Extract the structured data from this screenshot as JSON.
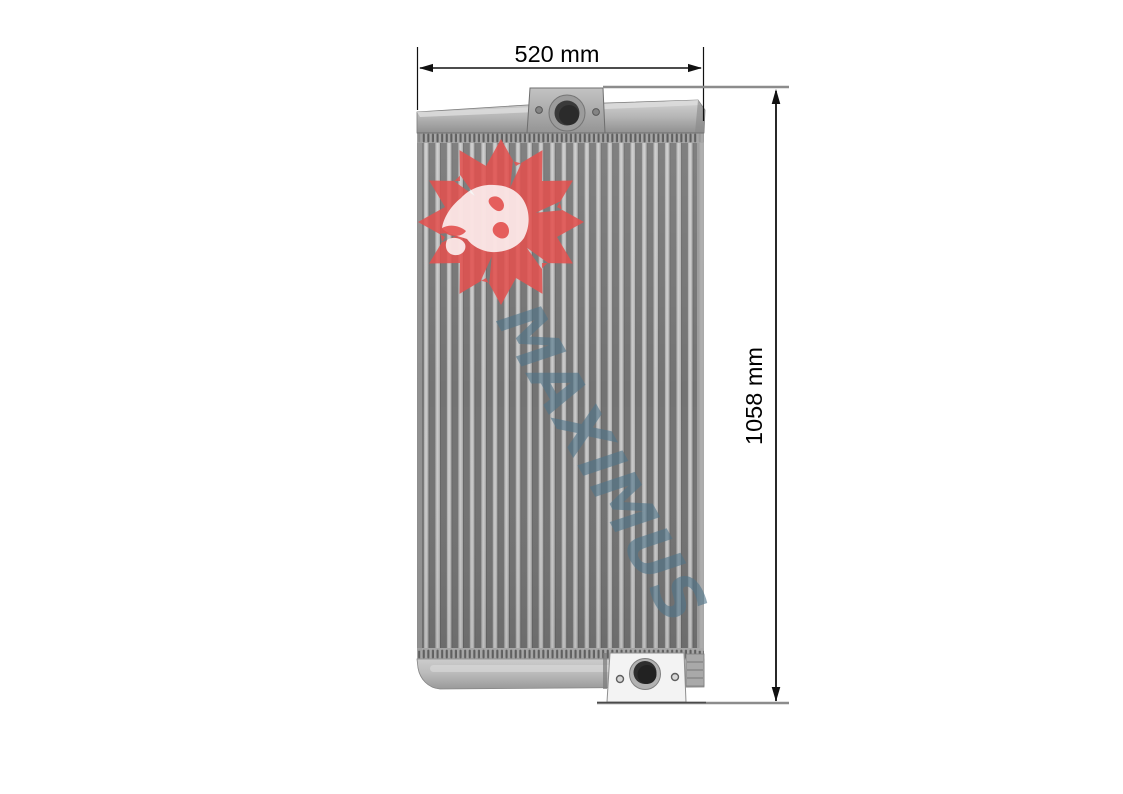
{
  "figure": {
    "description": "Dimensioned product photo of a vertical-fin radiator core with top and bottom mounting brackets",
    "width_dimension": {
      "label": "520 mm"
    },
    "height_dimension": {
      "label": "1058 mm"
    },
    "watermark": {
      "text": "MAXIMUS"
    },
    "logo": {
      "name": "maximus-lion-icon"
    },
    "colors": {
      "logo_red": "#e2504e",
      "lion_white": "#ffffff",
      "watermark_blue": "#50758a",
      "dimension_line": "#111111",
      "extension_line_gray": "#8c8c8c",
      "core_fin_dark": "#737373",
      "core_tube_light": "#b3b3b3"
    }
  }
}
